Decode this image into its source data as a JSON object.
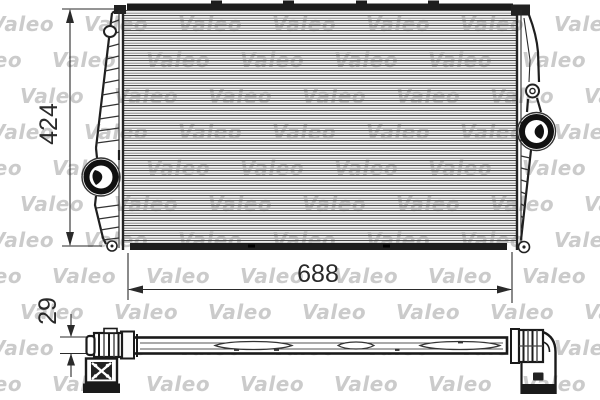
{
  "watermark": {
    "text": "Valeo"
  },
  "diagram": {
    "title": "intercooler-technical-drawing",
    "dimensions": {
      "height": "424",
      "width": "688",
      "depth": "29"
    }
  }
}
